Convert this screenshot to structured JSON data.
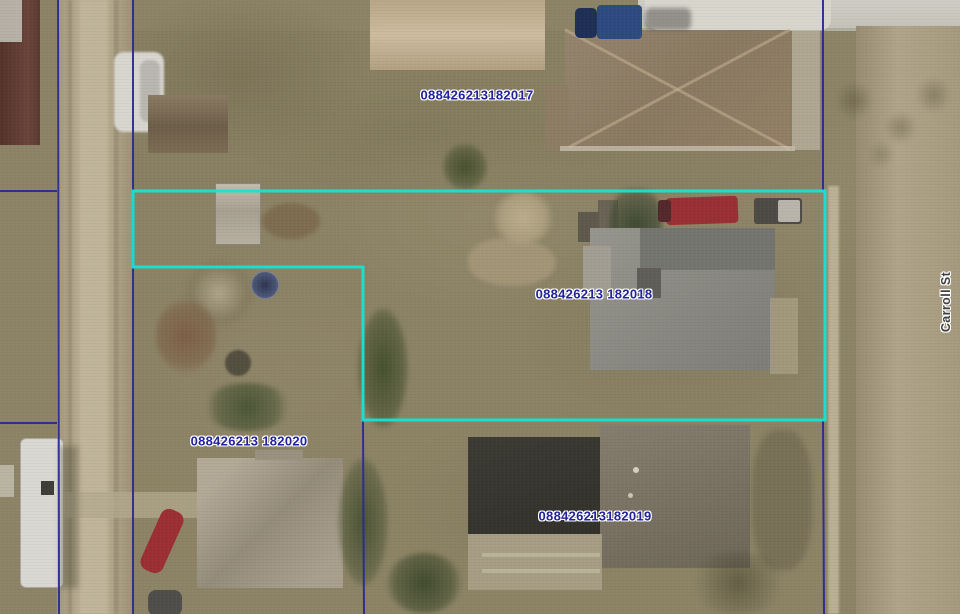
{
  "map": {
    "street_label": "Carroll St",
    "parcels": [
      {
        "id": "088426213182017"
      },
      {
        "id": "088426213 182018"
      },
      {
        "id": "088426213182019"
      },
      {
        "id": "088426213 182020"
      }
    ],
    "colors": {
      "parcel_line": "#2a2a94",
      "selected_parcel": "#14e4d4",
      "parcel_label": "#22229e",
      "street_label": "#3f3f3f"
    }
  }
}
